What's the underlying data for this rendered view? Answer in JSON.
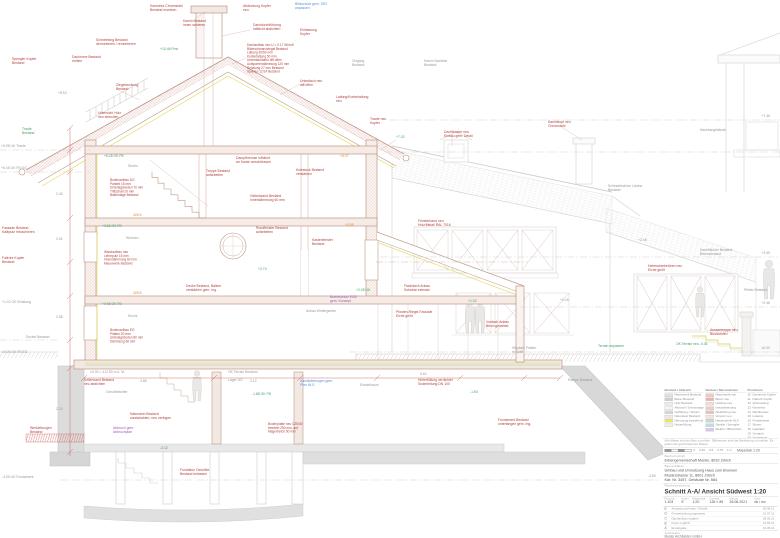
{
  "title_block": {
    "note": "Alle Masse sind am Bau zu prüfen. Differenzen sind der Bauleitung zu melden. Es gelten die geschriebenen Masse.",
    "scalebar_labels": [
      "0",
      "0.25",
      "0.5",
      "0.75",
      "1 m"
    ],
    "scalebar_caption": "Massstab 1:20",
    "client_label": "Bauherrschaft",
    "client": "Erbengemeinschaft Muster, 8032 Zürich",
    "project_label": "Bauvorhaben",
    "project_lines": [
      "Umbau und Umnutzung Haus zum Brunnen",
      "Musterstrasse 11, 8001 Zürich",
      "Kat. Nr. 3457, Gebäude Nr. 584"
    ],
    "plan_label": "Planbezeichnung",
    "plan_title": "Schnitt A-A/ Ansicht Südwest 1:20",
    "fields": [
      {
        "label": "Plan Nr.",
        "value": "1.103"
      },
      {
        "label": "Index",
        "value": "E"
      },
      {
        "label": "Massstab",
        "value": "1:20"
      },
      {
        "label": "Format",
        "value": "126 × 89"
      },
      {
        "label": "Datum",
        "value": "26.08.2021"
      },
      {
        "label": "Gez.",
        "value": "bk / mv"
      }
    ],
    "revisions": [
      {
        "i": "E",
        "t": "Anpassung Anbau / Details",
        "d": "26.08.21"
      },
      {
        "i": "D",
        "t": "Fensterteilung angepasst",
        "d": "12.07.21"
      },
      {
        "i": "C",
        "t": "Dachaufbau ergänzt",
        "d": "28.06.21"
      },
      {
        "i": "B",
        "t": "Koten ergänzt",
        "d": "14.06.21"
      },
      {
        "i": "A",
        "t": "Erstabgabe",
        "d": "31.05.21"
      }
    ],
    "architect_label": "Architektur",
    "architect_lines": [
      "Muster Architekten GmbH",
      "Bahnhofstrasse 12, 8001 Zürich",
      "T +41 44 000 00 00   mail@muster-arch.ch"
    ]
  },
  "legend": {
    "col1_header": "Bestand / Abbruch",
    "col1": [
      {
        "c": "#e0e0e0",
        "l": "Mauerwerk Bestand"
      },
      {
        "c": "#cfcfcf",
        "l": "Beton Bestand"
      },
      {
        "c": "#ececec",
        "l": "Holz Bestand"
      },
      {
        "c": "#f5f5f5",
        "l": "Abbruch / Demontage"
      },
      {
        "c": "#d6d6d6",
        "l": "Auffüllung / Terrain"
      },
      {
        "c": "#e9e9e9",
        "l": "Naturstein Bestand"
      },
      {
        "c": "#ece84f",
        "l": "Dämmung bestehend"
      },
      {
        "c": "#f0efe2",
        "l": "Hinterfüllung"
      }
    ],
    "col2_header": "Neubau / Massnahmen",
    "col2": [
      {
        "c": "#f0c7c3",
        "l": "Mauerwerk neu"
      },
      {
        "c": "#e9b1ac",
        "l": "Beton neu"
      },
      {
        "c": "#f6dad7",
        "l": "Holzbau neu"
      },
      {
        "c": "#f1cdc9",
        "l": "Instandsetzung"
      },
      {
        "c": "#eebfba",
        "l": "Abdichtung neu"
      },
      {
        "c": "#f6e3e1",
        "l": "Verputz neu"
      },
      {
        "c": "#bfe0c6",
        "l": "Haustechnik HLS"
      },
      {
        "c": "#c3d9f2",
        "l": "Sanitär / Spengler"
      },
      {
        "c": "#dcc6ec",
        "l": "Elektro / Blitzschutz"
      }
    ],
    "col3_header": "Positionen",
    "col3": [
      {
        "n": "10",
        "l": "Dachrinne Kupfer"
      },
      {
        "n": "11",
        "l": "Fallrohr Kupfer"
      },
      {
        "n": "12",
        "l": "Schneefang"
      },
      {
        "n": "13",
        "l": "Kaminhut"
      },
      {
        "n": "14",
        "l": "Dachfenster"
      },
      {
        "n": "15",
        "l": "Lukarne"
      },
      {
        "n": "16",
        "l": "Fensterbank"
      },
      {
        "n": "17",
        "l": "Storen"
      },
      {
        "n": "18",
        "l": "Geländer"
      },
      {
        "n": "19",
        "l": "Vordach"
      },
      {
        "n": "20",
        "l": "Sockelputz"
      },
      {
        "n": "21",
        "l": "Aussentreppe"
      }
    ],
    "extra": [
      {
        "t": "Änderungen rot markiert",
        "c": "#c0392b"
      },
      {
        "t": "Details siehe Detailpläne",
        "c": "#5b8fd4"
      }
    ]
  },
  "drawing": {
    "levels": [
      {
        "x1": 0,
        "x2": 90,
        "y": 150,
        "c": "k"
      },
      {
        "x1": 0,
        "x2": 90,
        "y": 172,
        "c": "k"
      },
      {
        "x1": 390,
        "x2": 780,
        "y": 120,
        "c": "k"
      },
      {
        "x1": 386,
        "x2": 780,
        "y": 152,
        "c": "k"
      },
      {
        "x1": 380,
        "x2": 780,
        "y": 257,
        "c": "k"
      },
      {
        "x1": 520,
        "x2": 780,
        "y": 307,
        "c": "k"
      },
      {
        "x1": 350,
        "x2": 780,
        "y": 352,
        "c": "k"
      },
      {
        "x1": 376,
        "x2": 528,
        "y": 262,
        "c": "r"
      },
      {
        "x1": 0,
        "x2": 58,
        "y": 340,
        "c": "k"
      },
      {
        "x1": 60,
        "x2": 660,
        "y": 480,
        "c": "k"
      }
    ],
    "annotations": [
      {
        "x": 150,
        "y": 7,
        "t": "Kaminhut Chromstahl\nBestand ersetzen",
        "c": "r"
      },
      {
        "x": 243,
        "y": 7,
        "t": "Abdeckung Kupfer\nneu",
        "c": "r"
      },
      {
        "x": 295,
        "y": 5,
        "t": "Blitzschutz gem. SEV\nanpassen",
        "c": "b"
      },
      {
        "x": 183,
        "y": 22,
        "t": "Kamin Bestand\ninnen sanieren",
        "c": "r"
      },
      {
        "x": 253,
        "y": 26,
        "t": "Dachdurchführung\nluftdicht abdichten",
        "c": "r"
      },
      {
        "x": 300,
        "y": 31,
        "t": "Einfassung\nKupfer",
        "c": "r"
      },
      {
        "x": 96,
        "y": 41,
        "t": "Schneefang Bestand\ndemontieren / remontieren",
        "c": "r"
      },
      {
        "x": 160,
        "y": 50,
        "t": "+10.46 First",
        "c": "g"
      },
      {
        "x": 247,
        "y": 46,
        "t": "Dachaufbau neu  U = 0.17 W/m²K\nBiberschwanzziegel Bestand\nLattung 30/50 mm\nKonterlattung 50 mm\nUnterdachbahn diff.offen\nAufsparrendämmung 120 mm\nSchalung 27 mm Bestand\nSparren 12/14 Bestand",
        "c": "r",
        "s": 3.2
      },
      {
        "x": 352,
        "y": 62,
        "t": "Ortgang\nBestand",
        "c": "k"
      },
      {
        "x": 12,
        "y": 60,
        "t": "Spengler Kupfer\nBestand",
        "c": "r"
      },
      {
        "x": 72,
        "y": 58,
        "t": "Dachrinne Bestand\nrichten",
        "c": "r"
      },
      {
        "x": 116,
        "y": 86,
        "t": "Ziegeldeckung\nBestand",
        "c": "r"
      },
      {
        "x": 58,
        "y": 94,
        "t": "+8.53",
        "c": "k"
      },
      {
        "x": 98,
        "y": 114,
        "t": "Untersicht Holz\nneu streichen",
        "c": "r"
      },
      {
        "x": 22,
        "y": 130,
        "t": "Traufe\nBestand",
        "c": "g"
      },
      {
        "x": 1,
        "y": 147,
        "t": "+6.98 UK Traufe",
        "c": "k"
      },
      {
        "x": 1,
        "y": 169,
        "t": "+6.45 OK FB DG",
        "c": "k"
      },
      {
        "x": 300,
        "y": 82,
        "t": "Unterdach neu\ndiff.offen",
        "c": "r"
      },
      {
        "x": 336,
        "y": 98,
        "t": "Lattung/Konterlattung\nneu",
        "c": "r"
      },
      {
        "x": 370,
        "y": 120,
        "t": "Traufe neu\nKupfer",
        "c": "r"
      },
      {
        "x": 396,
        "y": 138,
        "t": "+7.02",
        "c": "g"
      },
      {
        "x": 424,
        "y": 62,
        "t": "Kamin Nachbar\nBestand",
        "c": "k"
      },
      {
        "x": 104,
        "y": 157,
        "t": "+6.45 OK FB",
        "c": "g"
      },
      {
        "x": 128,
        "y": 167,
        "t": "Studio",
        "c": "k"
      },
      {
        "x": 110,
        "y": 181,
        "t": "Bodenaufbau DG\nParkett 15 mm\nUnterlagsboden 70 mm\nTrittschall 20 mm\nBalkenlage Bestand",
        "c": "r",
        "s": 3.2
      },
      {
        "x": 236,
        "y": 159,
        "t": "Dampfbremse luftdicht\nan Kamin anschliessen",
        "c": "r"
      },
      {
        "x": 296,
        "y": 171,
        "t": "Kniestock Bestand\nverstärken",
        "c": "r"
      },
      {
        "x": 340,
        "y": 157,
        "t": "+6.07",
        "c": "o"
      },
      {
        "x": 250,
        "y": 197,
        "t": "Giebelwand Bestand\nInnendämmung 60 mm",
        "c": "r"
      },
      {
        "x": 206,
        "y": 172,
        "t": "Treppe Bestand\naufarbeiten",
        "c": "r"
      },
      {
        "x": 102,
        "y": 227,
        "t": "+3.82 OK FB",
        "c": "g"
      },
      {
        "x": 126,
        "y": 239,
        "t": "Wohnen",
        "c": "k"
      },
      {
        "x": 104,
        "y": 253,
        "t": "Wandaufbau neu\nLehmputz 15 mm\nInnendämmung 60 mm\nMauerwerk Bestand",
        "c": "r",
        "s": 3.2
      },
      {
        "x": 256,
        "y": 229,
        "t": "Rundfenster Bestand\naufarbeiten",
        "c": "r"
      },
      {
        "x": 312,
        "y": 241,
        "t": "Kastenfenster\nBestand",
        "c": "r"
      },
      {
        "x": 345,
        "y": 226,
        "t": "+3.55",
        "c": "o"
      },
      {
        "x": 186,
        "y": 287,
        "t": "Decke Bestand, Balken\nverstärken gem. Ing.",
        "c": "r"
      },
      {
        "x": 258,
        "y": 270,
        "t": "+2.74",
        "c": "g"
      },
      {
        "x": 133,
        "y": 216,
        "t": "426.5",
        "c": "o"
      },
      {
        "x": 133,
        "y": 294,
        "t": "425.8",
        "c": "o"
      },
      {
        "x": 102,
        "y": 305,
        "t": "+0.96 OK FB",
        "c": "g"
      },
      {
        "x": 128,
        "y": 317,
        "t": "Küche",
        "c": "k"
      },
      {
        "x": 110,
        "y": 331,
        "t": "Bodenaufbau EG\nPlatten 20 mm\nUnterlagsboden 80 mm\nDämmung 60 mm",
        "c": "r",
        "s": 3.2
      },
      {
        "x": 306,
        "y": 312,
        "t": "Anbau Wintergarten",
        "c": "k"
      },
      {
        "x": 396,
        "y": 313,
        "t": "Pfosten-Riegel-Fassade\nEiche geölt",
        "c": "r"
      },
      {
        "x": 468,
        "y": 302,
        "t": "+1.02",
        "c": "g"
      },
      {
        "x": 486,
        "y": 323,
        "t": "Vordach Anbau\nBlech gekantet",
        "c": "r"
      },
      {
        "x": 356,
        "y": 291,
        "t": "+2.08 UK",
        "c": "g"
      },
      {
        "x": 404,
        "y": 287,
        "t": "Flachdach Anbau\nSubstrat extensiv",
        "c": "r"
      },
      {
        "x": 330,
        "y": 298,
        "t": "Brandschutz EI30\ngem. Konzept",
        "c": "p"
      },
      {
        "x": 90,
        "y": 373,
        "t": "±0.00 = 412.50 m ü. M.",
        "c": "k"
      },
      {
        "x": 228,
        "y": 373,
        "t": "OK Terrain Bestand",
        "c": "k"
      },
      {
        "x": 84,
        "y": 381,
        "t": "Kellerwand Bestand\nneu abdichten",
        "c": "r"
      },
      {
        "x": 106,
        "y": 393,
        "t": "Gewölbekeller",
        "c": "k"
      },
      {
        "x": 130,
        "y": 415,
        "t": "Naturstein Bestand\nsandstrahlen, neu verfugen",
        "c": "r"
      },
      {
        "x": 228,
        "y": 381,
        "t": "Lager UG",
        "c": "k"
      },
      {
        "x": 252,
        "y": 395,
        "t": "-1.88 OK FB",
        "c": "g"
      },
      {
        "x": 268,
        "y": 425,
        "t": "Bodenplatte neu C25/30\nbewehrt 250 mm, auf\nMagerbeton 50 mm",
        "c": "r",
        "s": 3.2
      },
      {
        "x": 300,
        "y": 382,
        "t": "Sanitärleitungen gem.\nPlan HLS",
        "c": "b"
      },
      {
        "x": 113,
        "y": 429,
        "t": "Abbruch gem.\nAbbruchplan",
        "c": "p"
      },
      {
        "x": 160,
        "y": 449,
        "t": "-3.12",
        "c": "g"
      },
      {
        "x": 360,
        "y": 386,
        "t": "Einstellraum",
        "c": "k"
      },
      {
        "x": 418,
        "y": 381,
        "t": "Hinterfüllung verdichtet\nSickerleitung DN 100",
        "c": "r"
      },
      {
        "x": 470,
        "y": 393,
        "t": "-1.54",
        "c": "g"
      },
      {
        "x": 498,
        "y": 421,
        "t": "Fundament Bestand\nunterfangen gem. Ing.",
        "c": "r"
      },
      {
        "x": 568,
        "y": 381,
        "t": "Rampe Bestand",
        "c": "k"
      },
      {
        "x": 180,
        "y": 471,
        "t": "Fundation Gewölbe\nBestand belassen",
        "c": "r"
      },
      {
        "x": 30,
        "y": 429,
        "t": "Werkleitungen\nBestand",
        "c": "r"
      },
      {
        "x": 444,
        "y": 133,
        "t": "Dachfenster neu\nEinbau gem. Detail",
        "c": "r"
      },
      {
        "x": 548,
        "y": 123,
        "t": "Kaminkopf neu\nChromstahl",
        "c": "r"
      },
      {
        "x": 608,
        "y": 187,
        "t": "Schindelschirm Lärche\nBestand",
        "c": "k"
      },
      {
        "x": 418,
        "y": 222,
        "t": "Fensterband neu\nHolz/Metall RAL 7016",
        "c": "r"
      },
      {
        "x": 700,
        "y": 251,
        "t": "Dachflächen Bestand\nBiberschwanz",
        "c": "k"
      },
      {
        "x": 648,
        "y": 267,
        "t": "Hebeschiebetüren neu\nEiche geölt",
        "c": "r"
      },
      {
        "x": 700,
        "y": 131,
        "t": "Nachbargebäude",
        "c": "k"
      },
      {
        "x": 676,
        "y": 345,
        "t": "OK Terrain neu -0.35",
        "c": "g"
      },
      {
        "x": 598,
        "y": 347,
        "t": "Terrain anpassen",
        "c": "g"
      },
      {
        "x": 710,
        "y": 331,
        "t": "Aussentreppe neu\nBlockstufen",
        "c": "r"
      },
      {
        "x": 744,
        "y": 291,
        "t": "Pfeiler Bestand",
        "c": "k"
      },
      {
        "x": 512,
        "y": 349,
        "t": "Sitzplatz Platten\nin Splitt",
        "c": "k"
      },
      {
        "x": 560,
        "y": 301,
        "t": "+0.45",
        "c": "k"
      },
      {
        "x": 638,
        "y": 241,
        "t": "+2.46",
        "c": "k"
      },
      {
        "x": 2,
        "y": 229,
        "t": "Fassade Bestand\nKalkputz retuschieren",
        "c": "r"
      },
      {
        "x": 2,
        "y": 259,
        "t": "Fallrohr Kupfer\nBestand",
        "c": "r"
      },
      {
        "x": 2,
        "y": 303,
        "t": "+1.02 OK Brüstung",
        "c": "k"
      },
      {
        "x": 26,
        "y": 338,
        "t": "Sockel Bestand",
        "c": "k"
      },
      {
        "x": 2,
        "y": 353,
        "t": "±0.00 OK FB EG",
        "c": "k"
      },
      {
        "x": 2,
        "y": 478,
        "t": "-4.05 UK Fundament",
        "c": "k"
      },
      {
        "x": 770,
        "y": 117,
        "t": "+7.46",
        "c": "k",
        "a": "e"
      },
      {
        "x": 770,
        "y": 254,
        "t": "+3.55",
        "c": "k",
        "a": "e"
      },
      {
        "x": 770,
        "y": 304,
        "t": "+2.46",
        "c": "k",
        "a": "e"
      },
      {
        "x": 770,
        "y": 349,
        "t": "±0.00",
        "c": "k",
        "a": "e"
      },
      {
        "x": 648,
        "y": 477,
        "t": "-3.60",
        "c": "k"
      },
      {
        "x": 56,
        "y": 195,
        "t": "2.45",
        "c": "k"
      },
      {
        "x": 56,
        "y": 240,
        "t": "2.62",
        "c": "k"
      },
      {
        "x": 56,
        "y": 318,
        "t": "2.58",
        "c": "k"
      },
      {
        "x": 56,
        "y": 410,
        "t": "2.24",
        "c": "k"
      },
      {
        "x": 140,
        "y": 382,
        "t": "4.86",
        "c": "k"
      },
      {
        "x": 250,
        "y": 382,
        "t": "3.12",
        "c": "k"
      },
      {
        "x": 420,
        "y": 375,
        "t": "5.62",
        "c": "k"
      }
    ]
  }
}
